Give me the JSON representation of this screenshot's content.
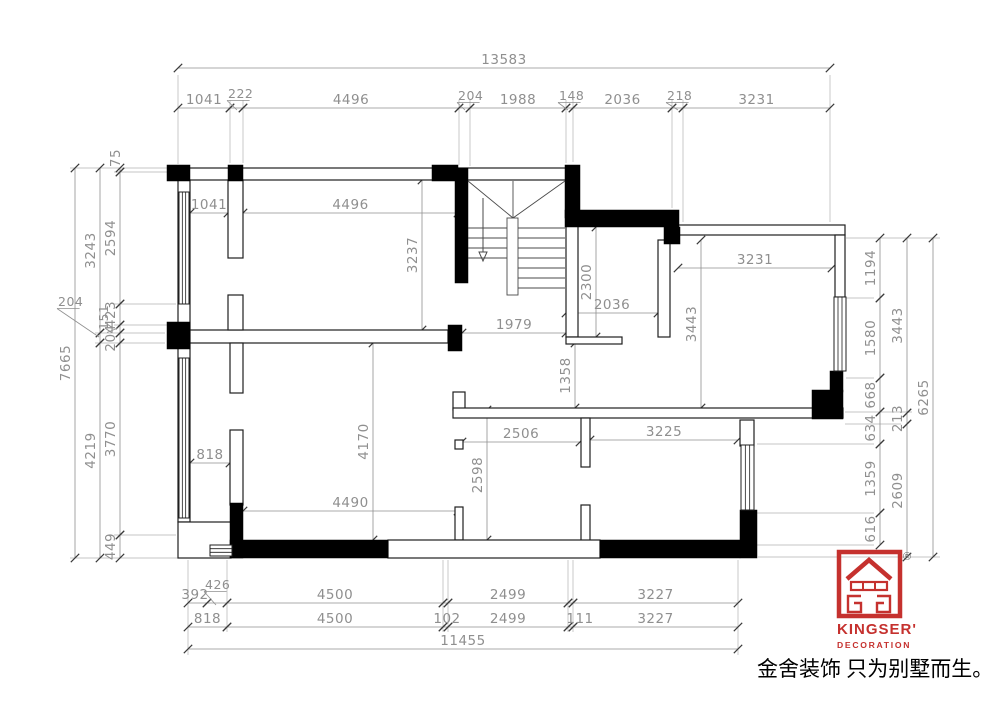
{
  "branding": {
    "logo_name": "KINGSER'",
    "logo_sub": "DECORATION",
    "registered_mark": "®",
    "tagline": "金舍装饰 只为别墅而生。",
    "brand_red": "#c5312e"
  },
  "colors": {
    "wall": "#000000",
    "outline": "#1f1f1f",
    "dim": "#8f8f8f",
    "tick": "#3a3a3a",
    "ext": "#b3b3b3",
    "stair": "#4a4a4a"
  },
  "plan": {
    "dims_h": [
      {
        "t": "13583",
        "x1": 178,
        "x2": 830,
        "y": 68
      },
      {
        "t": "1041",
        "x1": 178,
        "x2": 230,
        "y": 108
      },
      {
        "t": "",
        "x1": 230,
        "x2": 243,
        "y": 108
      },
      {
        "t": "4496",
        "x1": 243,
        "x2": 459,
        "y": 108
      },
      {
        "t": "",
        "x1": 459,
        "x2": 470,
        "y": 108
      },
      {
        "t": "1988",
        "x1": 470,
        "x2": 566,
        "y": 108
      },
      {
        "t": "",
        "x1": 566,
        "x2": 573,
        "y": 108
      },
      {
        "t": "2036",
        "x1": 573,
        "x2": 672,
        "y": 108
      },
      {
        "t": "",
        "x1": 672,
        "x2": 683,
        "y": 108
      },
      {
        "t": "3231",
        "x1": 683,
        "x2": 830,
        "y": 108
      },
      {
        "t": "1041",
        "x1": 190,
        "x2": 228,
        "y": 213
      },
      {
        "t": "4496",
        "x1": 243,
        "x2": 458,
        "y": 213
      },
      {
        "t": "1979",
        "x1": 462,
        "x2": 566,
        "y": 333
      },
      {
        "t": "2036",
        "x1": 566,
        "x2": 658,
        "y": 313
      },
      {
        "t": "3231",
        "x1": 678,
        "x2": 832,
        "y": 268
      },
      {
        "t": "2506",
        "x1": 462,
        "x2": 580,
        "y": 442
      },
      {
        "t": "3225",
        "x1": 590,
        "x2": 738,
        "y": 440
      },
      {
        "t": "818",
        "x1": 190,
        "x2": 230,
        "y": 463
      },
      {
        "t": "4490",
        "x1": 243,
        "x2": 458,
        "y": 511
      },
      {
        "t": "392",
        "x1": 188,
        "x2": 207,
        "y": 603,
        "tx": 195
      },
      {
        "t": "",
        "x1": 207,
        "x2": 227,
        "y": 603
      },
      {
        "t": "4500",
        "x1": 227,
        "x2": 443,
        "y": 603
      },
      {
        "t": "",
        "x1": 443,
        "x2": 448,
        "y": 603
      },
      {
        "t": "2499",
        "x1": 448,
        "x2": 568,
        "y": 603
      },
      {
        "t": "",
        "x1": 568,
        "x2": 573,
        "y": 603
      },
      {
        "t": "3227",
        "x1": 573,
        "x2": 738,
        "y": 603
      },
      {
        "t": "818",
        "x1": 188,
        "x2": 227,
        "y": 627
      },
      {
        "t": "4500",
        "x1": 227,
        "x2": 443,
        "y": 627
      },
      {
        "t": "102",
        "x1": 443,
        "x2": 448,
        "y": 627,
        "tx": 447
      },
      {
        "t": "2499",
        "x1": 448,
        "x2": 568,
        "y": 627
      },
      {
        "t": "111",
        "x1": 568,
        "x2": 573,
        "y": 627,
        "tx": 580
      },
      {
        "t": "3227",
        "x1": 573,
        "x2": 738,
        "y": 627
      },
      {
        "t": "11455",
        "x1": 188,
        "x2": 738,
        "y": 649
      }
    ],
    "dims_v": [
      {
        "t": "7665",
        "x": 75,
        "y1": 168,
        "y2": 558
      },
      {
        "t": "3243",
        "x": 100,
        "y1": 168,
        "y2": 333
      },
      {
        "t": "",
        "x": 100,
        "y1": 333,
        "y2": 343
      },
      {
        "t": "4219",
        "x": 100,
        "y1": 343,
        "y2": 558
      },
      {
        "t": "75",
        "x": 120,
        "y1": 168,
        "y2": 172,
        "tx": 120,
        "ty": 158
      },
      {
        "t": "2594",
        "x": 120,
        "y1": 172,
        "y2": 304
      },
      {
        "t": "423",
        "x": 120,
        "y1": 304,
        "y2": 325
      },
      {
        "t": "",
        "x": 120,
        "y1": 325,
        "y2": 333
      },
      {
        "t": "204",
        "x": 120,
        "y1": 333,
        "y2": 343
      },
      {
        "t": "3770",
        "x": 120,
        "y1": 343,
        "y2": 535
      },
      {
        "t": "449",
        "x": 120,
        "y1": 535,
        "y2": 558
      },
      {
        "t": "3237",
        "x": 422,
        "y1": 180,
        "y2": 330
      },
      {
        "t": "2300",
        "x": 596,
        "y1": 227,
        "y2": 337
      },
      {
        "t": "3443",
        "x": 701,
        "y1": 240,
        "y2": 408
      },
      {
        "t": "1358",
        "x": 575,
        "y1": 343,
        "y2": 408
      },
      {
        "t": "2598",
        "x": 487,
        "y1": 410,
        "y2": 540
      },
      {
        "t": "4170",
        "x": 373,
        "y1": 343,
        "y2": 540
      },
      {
        "t": "1194",
        "x": 880,
        "y1": 238,
        "y2": 298
      },
      {
        "t": "1580",
        "x": 880,
        "y1": 298,
        "y2": 378
      },
      {
        "t": "668",
        "x": 880,
        "y1": 378,
        "y2": 412
      },
      {
        "t": "634",
        "x": 880,
        "y1": 412,
        "y2": 444
      },
      {
        "t": "1359",
        "x": 880,
        "y1": 444,
        "y2": 513
      },
      {
        "t": "616",
        "x": 880,
        "y1": 513,
        "y2": 545
      },
      {
        "t": "3443",
        "x": 907,
        "y1": 238,
        "y2": 413
      },
      {
        "t": "213",
        "x": 907,
        "y1": 413,
        "y2": 424
      },
      {
        "t": "2609",
        "x": 907,
        "y1": 424,
        "y2": 557
      },
      {
        "t": "6265",
        "x": 933,
        "y1": 238,
        "y2": 557
      }
    ],
    "leaders": [
      {
        "t": "222",
        "tx": 228,
        "ty": 98,
        "lx": 237,
        "ly": 110
      },
      {
        "t": "204",
        "tx": 458,
        "ty": 100,
        "lx": 465,
        "ly": 110
      },
      {
        "t": "148",
        "tx": 559,
        "ty": 100,
        "lx": 568,
        "ly": 110
      },
      {
        "t": "218",
        "tx": 667,
        "ty": 100,
        "lx": 678,
        "ly": 110
      },
      {
        "t": "426",
        "tx": 205,
        "ty": 589,
        "lx": 216,
        "ly": 605
      },
      {
        "t": "204",
        "tx": 58,
        "ty": 306,
        "lx": 99,
        "ly": 337
      },
      {
        "t": "151",
        "tx": 108,
        "ty": 330,
        "lx": 118,
        "ly": 328,
        "rot": -90
      }
    ],
    "ext_lines": [
      [
        178,
        75,
        178,
        164
      ],
      [
        830,
        75,
        830,
        222
      ],
      [
        230,
        100,
        230,
        163
      ],
      [
        243,
        100,
        243,
        163
      ],
      [
        459,
        100,
        459,
        165
      ],
      [
        470,
        100,
        470,
        166
      ],
      [
        566,
        100,
        566,
        163
      ],
      [
        573,
        100,
        573,
        162
      ],
      [
        672,
        100,
        672,
        208
      ],
      [
        683,
        100,
        683,
        222
      ],
      [
        70,
        168,
        176,
        168
      ],
      [
        70,
        558,
        228,
        558
      ],
      [
        95,
        333,
        165,
        333
      ],
      [
        95,
        343,
        165,
        343
      ],
      [
        114,
        172,
        176,
        172
      ],
      [
        114,
        304,
        176,
        304
      ],
      [
        114,
        325,
        176,
        325
      ],
      [
        114,
        535,
        176,
        535
      ],
      [
        846,
        238,
        940,
        238
      ],
      [
        758,
        557,
        940,
        557
      ],
      [
        846,
        298,
        874,
        298
      ],
      [
        846,
        378,
        874,
        378
      ],
      [
        845,
        412,
        912,
        412
      ],
      [
        845,
        424,
        901,
        424
      ],
      [
        757,
        444,
        874,
        444
      ],
      [
        757,
        513,
        874,
        513
      ],
      [
        757,
        545,
        874,
        545
      ],
      [
        188,
        560,
        188,
        655
      ],
      [
        738,
        560,
        738,
        655
      ],
      [
        227,
        560,
        227,
        632
      ],
      [
        443,
        560,
        443,
        632
      ],
      [
        448,
        560,
        448,
        632
      ],
      [
        568,
        560,
        568,
        632
      ],
      [
        573,
        560,
        573,
        632
      ]
    ],
    "walls_hollow": [
      [
        178,
        168,
        280,
        12
      ],
      [
        458,
        168,
        108,
        12
      ],
      [
        178,
        180,
        12,
        342
      ],
      [
        178,
        522,
        53,
        36
      ],
      [
        190,
        330,
        258,
        13
      ],
      [
        228,
        180,
        15,
        78
      ],
      [
        228,
        295,
        15,
        35
      ],
      [
        230,
        343,
        13,
        50
      ],
      [
        230,
        430,
        13,
        75
      ],
      [
        566,
        218,
        12,
        119
      ],
      [
        658,
        240,
        12,
        97
      ],
      [
        566,
        337,
        56,
        7
      ],
      [
        678,
        225,
        167,
        10
      ],
      [
        835,
        235,
        10,
        62
      ],
      [
        453,
        392,
        12,
        18
      ],
      [
        453,
        408,
        390,
        10
      ],
      [
        581,
        418,
        9,
        49
      ],
      [
        581,
        505,
        9,
        37
      ],
      [
        455,
        440,
        8,
        9
      ],
      [
        455,
        507,
        8,
        33
      ],
      [
        388,
        540,
        212,
        18
      ],
      [
        740,
        420,
        14,
        26
      ]
    ],
    "walls_black": [
      [
        167,
        165,
        23,
        16
      ],
      [
        228,
        165,
        15,
        16
      ],
      [
        432,
        165,
        26,
        16
      ],
      [
        455,
        168,
        13,
        115
      ],
      [
        565,
        165,
        15,
        53
      ],
      [
        565,
        210,
        114,
        17
      ],
      [
        664,
        227,
        16,
        17
      ],
      [
        167,
        322,
        23,
        27
      ],
      [
        448,
        325,
        14,
        26
      ],
      [
        230,
        503,
        13,
        55
      ],
      [
        230,
        540,
        158,
        18
      ],
      [
        600,
        540,
        140,
        18
      ],
      [
        740,
        510,
        17,
        48
      ],
      [
        812,
        390,
        31,
        29
      ],
      [
        830,
        371,
        13,
        21
      ]
    ],
    "windows": [
      {
        "x": 179,
        "y": 192,
        "w": 10,
        "h": 112,
        "o": "v"
      },
      {
        "x": 179,
        "y": 358,
        "w": 10,
        "h": 160,
        "o": "v"
      },
      {
        "x": 834,
        "y": 297,
        "w": 12,
        "h": 74,
        "o": "v"
      },
      {
        "x": 741,
        "y": 445,
        "w": 13,
        "h": 65,
        "o": "v"
      },
      {
        "x": 210,
        "y": 545,
        "w": 22,
        "h": 11,
        "o": "h"
      }
    ],
    "stair": {
      "diagonals": [
        [
          468,
          181,
          513,
          218
        ],
        [
          565,
          181,
          513,
          218
        ],
        [
          513,
          181,
          513,
          218
        ]
      ],
      "stringer": [
        507,
        218,
        11,
        77
      ],
      "treads_left": {
        "x1": 468,
        "x2": 507,
        "ys": [
          228,
          238,
          248,
          258
        ]
      },
      "treads_right": {
        "x1": 518,
        "x2": 565,
        "ys": [
          228,
          238,
          248,
          258,
          268,
          278,
          288
        ]
      },
      "arrow": {
        "x": 483,
        "y1": 198,
        "y2": 252
      }
    }
  }
}
